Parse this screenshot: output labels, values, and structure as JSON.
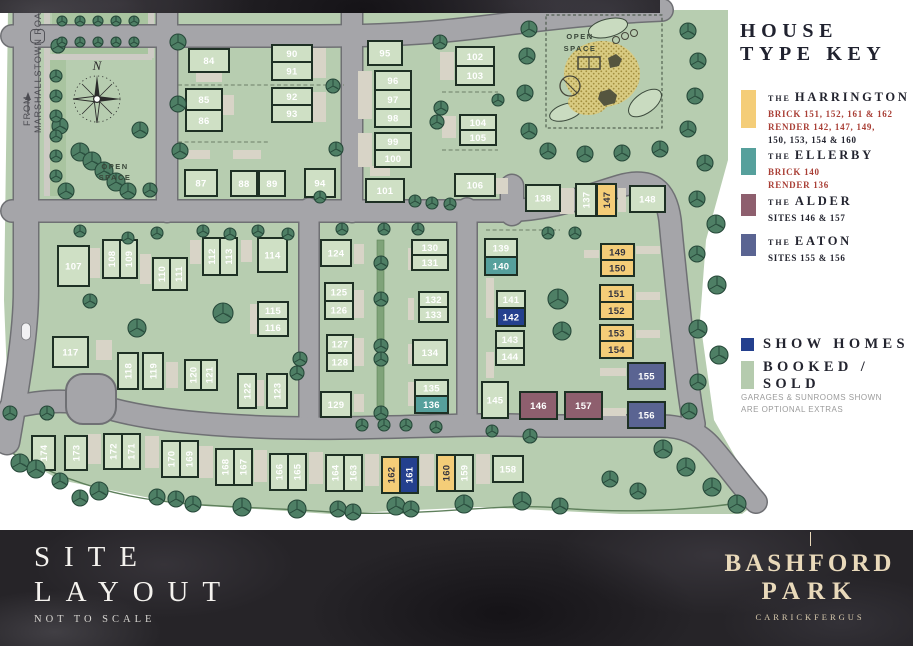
{
  "map": {
    "from_label": "FROM",
    "road_name": "MARSHALLSTOWN ROAD",
    "open_space_left_1": "OPEN",
    "open_space_left_2": "SPACE",
    "open_space_right_1": "OPEN",
    "open_space_right_2": "SPACE",
    "compass_north": "N",
    "plots": [
      [
        "84",
        189,
        49,
        40,
        23,
        0,
        "sold"
      ],
      [
        "85",
        186,
        89,
        36,
        21,
        0,
        "sold"
      ],
      [
        "86",
        186,
        110,
        36,
        21,
        0,
        "sold"
      ],
      [
        "87",
        185,
        170,
        32,
        26,
        0,
        "sold"
      ],
      [
        "88",
        231,
        171,
        26,
        25,
        0,
        "sold"
      ],
      [
        "89",
        259,
        171,
        26,
        25,
        0,
        "sold"
      ],
      [
        "90",
        272,
        45,
        40,
        17,
        0,
        "sold"
      ],
      [
        "91",
        272,
        62,
        40,
        18,
        0,
        "sold"
      ],
      [
        "92",
        272,
        88,
        40,
        17,
        0,
        "sold"
      ],
      [
        "93",
        272,
        105,
        40,
        17,
        0,
        "sold"
      ],
      [
        "94",
        305,
        169,
        30,
        28,
        0,
        "sold"
      ],
      [
        "95",
        368,
        41,
        34,
        24,
        0,
        "sold"
      ],
      [
        "96",
        375,
        71,
        36,
        19,
        0,
        "sold"
      ],
      [
        "97",
        375,
        90,
        36,
        19,
        0,
        "sold"
      ],
      [
        "98",
        375,
        109,
        36,
        18,
        0,
        "sold"
      ],
      [
        "99",
        375,
        133,
        36,
        17,
        0,
        "sold"
      ],
      [
        "100",
        375,
        150,
        36,
        17,
        0,
        "sold"
      ],
      [
        "101",
        366,
        179,
        38,
        23,
        0,
        "sold"
      ],
      [
        "102",
        456,
        47,
        38,
        19,
        0,
        "sold"
      ],
      [
        "103",
        456,
        66,
        38,
        19,
        0,
        "sold"
      ],
      [
        "104",
        460,
        115,
        36,
        15,
        0,
        "sold"
      ],
      [
        "105",
        460,
        130,
        36,
        15,
        0,
        "sold"
      ],
      [
        "106",
        455,
        174,
        40,
        22,
        0,
        "sold"
      ],
      [
        "107",
        58,
        246,
        31,
        40,
        0,
        "sold"
      ],
      [
        "108",
        103,
        240,
        17,
        38,
        1,
        "sold"
      ],
      [
        "109",
        120,
        240,
        17,
        38,
        1,
        "sold"
      ],
      [
        "110",
        153,
        258,
        17,
        32,
        1,
        "sold"
      ],
      [
        "111",
        170,
        258,
        17,
        32,
        1,
        "sold"
      ],
      [
        "112",
        203,
        238,
        17,
        37,
        1,
        "sold"
      ],
      [
        "113",
        220,
        238,
        17,
        37,
        1,
        "sold"
      ],
      [
        "114",
        258,
        238,
        29,
        34,
        0,
        "sold"
      ],
      [
        "115",
        258,
        302,
        30,
        17,
        0,
        "sold"
      ],
      [
        "116",
        258,
        319,
        30,
        17,
        0,
        "sold"
      ],
      [
        "117",
        53,
        337,
        35,
        30,
        0,
        "sold"
      ],
      [
        "118",
        118,
        353,
        20,
        36,
        1,
        "sold"
      ],
      [
        "119",
        143,
        353,
        20,
        36,
        1,
        "sold"
      ],
      [
        "120",
        185,
        360,
        16,
        30,
        1,
        "sold"
      ],
      [
        "121",
        201,
        360,
        16,
        30,
        1,
        "sold"
      ],
      [
        "122",
        238,
        374,
        18,
        34,
        1,
        "sold"
      ],
      [
        "123",
        267,
        374,
        20,
        34,
        1,
        "sold"
      ],
      [
        "124",
        321,
        240,
        30,
        26,
        0,
        "sold"
      ],
      [
        "125",
        325,
        283,
        28,
        18,
        0,
        "sold"
      ],
      [
        "126",
        325,
        301,
        28,
        18,
        0,
        "sold"
      ],
      [
        "127",
        327,
        335,
        26,
        18,
        0,
        "sold"
      ],
      [
        "128",
        327,
        353,
        26,
        18,
        0,
        "sold"
      ],
      [
        "129",
        321,
        392,
        30,
        25,
        0,
        "sold"
      ],
      [
        "130",
        412,
        240,
        36,
        15,
        0,
        "sold"
      ],
      [
        "131",
        412,
        255,
        36,
        15,
        0,
        "sold"
      ],
      [
        "132",
        419,
        292,
        29,
        15,
        0,
        "sold"
      ],
      [
        "133",
        419,
        307,
        29,
        15,
        0,
        "sold"
      ],
      [
        "134",
        413,
        340,
        34,
        25,
        0,
        "sold"
      ],
      [
        "135",
        415,
        380,
        33,
        16,
        0,
        "sold"
      ],
      [
        "136",
        415,
        396,
        33,
        17,
        0,
        "ellerby"
      ],
      [
        "137",
        576,
        184,
        20,
        32,
        1,
        "sold"
      ],
      [
        "138",
        526,
        185,
        34,
        26,
        0,
        "sold"
      ],
      [
        "139",
        485,
        239,
        32,
        18,
        0,
        "sold"
      ],
      [
        "140",
        485,
        257,
        32,
        18,
        0,
        "ellerby"
      ],
      [
        "141",
        497,
        291,
        28,
        17,
        0,
        "sold"
      ],
      [
        "142",
        497,
        308,
        28,
        18,
        0,
        "show"
      ],
      [
        "143",
        496,
        331,
        28,
        17,
        0,
        "sold"
      ],
      [
        "144",
        496,
        348,
        28,
        17,
        0,
        "sold"
      ],
      [
        "145",
        482,
        382,
        26,
        36,
        0,
        "sold"
      ],
      [
        "146",
        520,
        392,
        37,
        27,
        0,
        "alder"
      ],
      [
        "147",
        597,
        184,
        19,
        32,
        1,
        "harrington"
      ],
      [
        "148",
        630,
        186,
        35,
        26,
        0,
        "sold"
      ],
      [
        "149",
        601,
        244,
        33,
        16,
        0,
        "harrington"
      ],
      [
        "150",
        601,
        260,
        33,
        16,
        0,
        "harrington"
      ],
      [
        "151",
        600,
        285,
        33,
        17,
        0,
        "harrington"
      ],
      [
        "152",
        600,
        302,
        33,
        17,
        0,
        "harrington"
      ],
      [
        "153",
        600,
        325,
        33,
        16,
        0,
        "harrington"
      ],
      [
        "154",
        600,
        341,
        33,
        17,
        0,
        "harrington"
      ],
      [
        "155",
        628,
        363,
        37,
        26,
        0,
        "eaton"
      ],
      [
        "156",
        628,
        402,
        37,
        26,
        0,
        "eaton"
      ],
      [
        "157",
        565,
        392,
        37,
        27,
        0,
        "alder"
      ],
      [
        "158",
        493,
        456,
        30,
        26,
        0,
        "sold"
      ],
      [
        "159",
        455,
        455,
        18,
        36,
        1,
        "sold"
      ],
      [
        "160",
        437,
        455,
        18,
        36,
        1,
        "harrington"
      ],
      [
        "161",
        400,
        457,
        18,
        36,
        1,
        "show"
      ],
      [
        "162",
        382,
        457,
        18,
        36,
        1,
        "harrington"
      ],
      [
        "163",
        344,
        455,
        18,
        36,
        1,
        "sold"
      ],
      [
        "164",
        326,
        455,
        18,
        36,
        1,
        "sold"
      ],
      [
        "165",
        288,
        454,
        18,
        36,
        1,
        "sold"
      ],
      [
        "166",
        270,
        454,
        18,
        36,
        1,
        "sold"
      ],
      [
        "167",
        234,
        449,
        18,
        36,
        1,
        "sold"
      ],
      [
        "168",
        216,
        449,
        18,
        36,
        1,
        "sold"
      ],
      [
        "169",
        180,
        441,
        18,
        36,
        1,
        "sold"
      ],
      [
        "170",
        162,
        441,
        18,
        36,
        1,
        "sold"
      ],
      [
        "171",
        122,
        434,
        18,
        35,
        1,
        "sold"
      ],
      [
        "172",
        104,
        434,
        18,
        35,
        1,
        "sold"
      ],
      [
        "173",
        65,
        436,
        22,
        34,
        1,
        "sold"
      ],
      [
        "174",
        32,
        436,
        23,
        34,
        1,
        "sold"
      ]
    ]
  },
  "palette": {
    "sold": "#cfe0c5",
    "harrington": "#f4cd78",
    "ellerby": "#56a09c",
    "alder": "#8e5f6e",
    "eaton": "#5a6492",
    "show": "#24408e",
    "booked_green": "#b5cbae",
    "dark_text": "#33333f",
    "red_text": "#a93e35"
  },
  "legend": {
    "title_line1": "HOUSE",
    "title_line2": "TYPE KEY",
    "entries": [
      {
        "the": "THE",
        "name": "HARRINGTON",
        "type": "harrington",
        "swatch_h": 38,
        "top": 0,
        "lines": [
          {
            "text": "BRICK 151, 152, 161 & 162",
            "red": true
          },
          {
            "text": "RENDER 142, 147, 149,",
            "red": true
          },
          {
            "text": "150, 153, 154 & 160",
            "red": false
          }
        ]
      },
      {
        "the": "THE",
        "name": "ELLERBY",
        "type": "ellerby",
        "swatch_h": 27,
        "top": 58,
        "lines": [
          {
            "text": "BRICK 140",
            "red": true
          },
          {
            "text": "RENDER 136",
            "red": true
          }
        ]
      },
      {
        "the": "THE",
        "name": "ALDER",
        "type": "alder",
        "swatch_h": 22,
        "top": 104,
        "lines": [
          {
            "text": "SITES 146 & 157",
            "red": false
          }
        ]
      },
      {
        "the": "THE",
        "name": "EATON",
        "type": "eaton",
        "swatch_h": 22,
        "top": 144,
        "lines": [
          {
            "text": "SITES 155 & 156",
            "red": false
          }
        ]
      }
    ],
    "show_homes_label": "SHOW HOMES",
    "booked_label_1": "BOOKED /",
    "booked_label_2": "SOLD",
    "note_line1": "GARAGES & SUNROOMS SHOWN",
    "note_line2": "ARE OPTIONAL EXTRAS"
  },
  "footer": {
    "title_line1": "SITE",
    "title_line2": "LAYOUT",
    "subtitle": "NOT TO SCALE",
    "brand_line1": "BASHFORD",
    "brand_line2": "PARK",
    "brand_sub": "CARRICKFERGUS"
  }
}
